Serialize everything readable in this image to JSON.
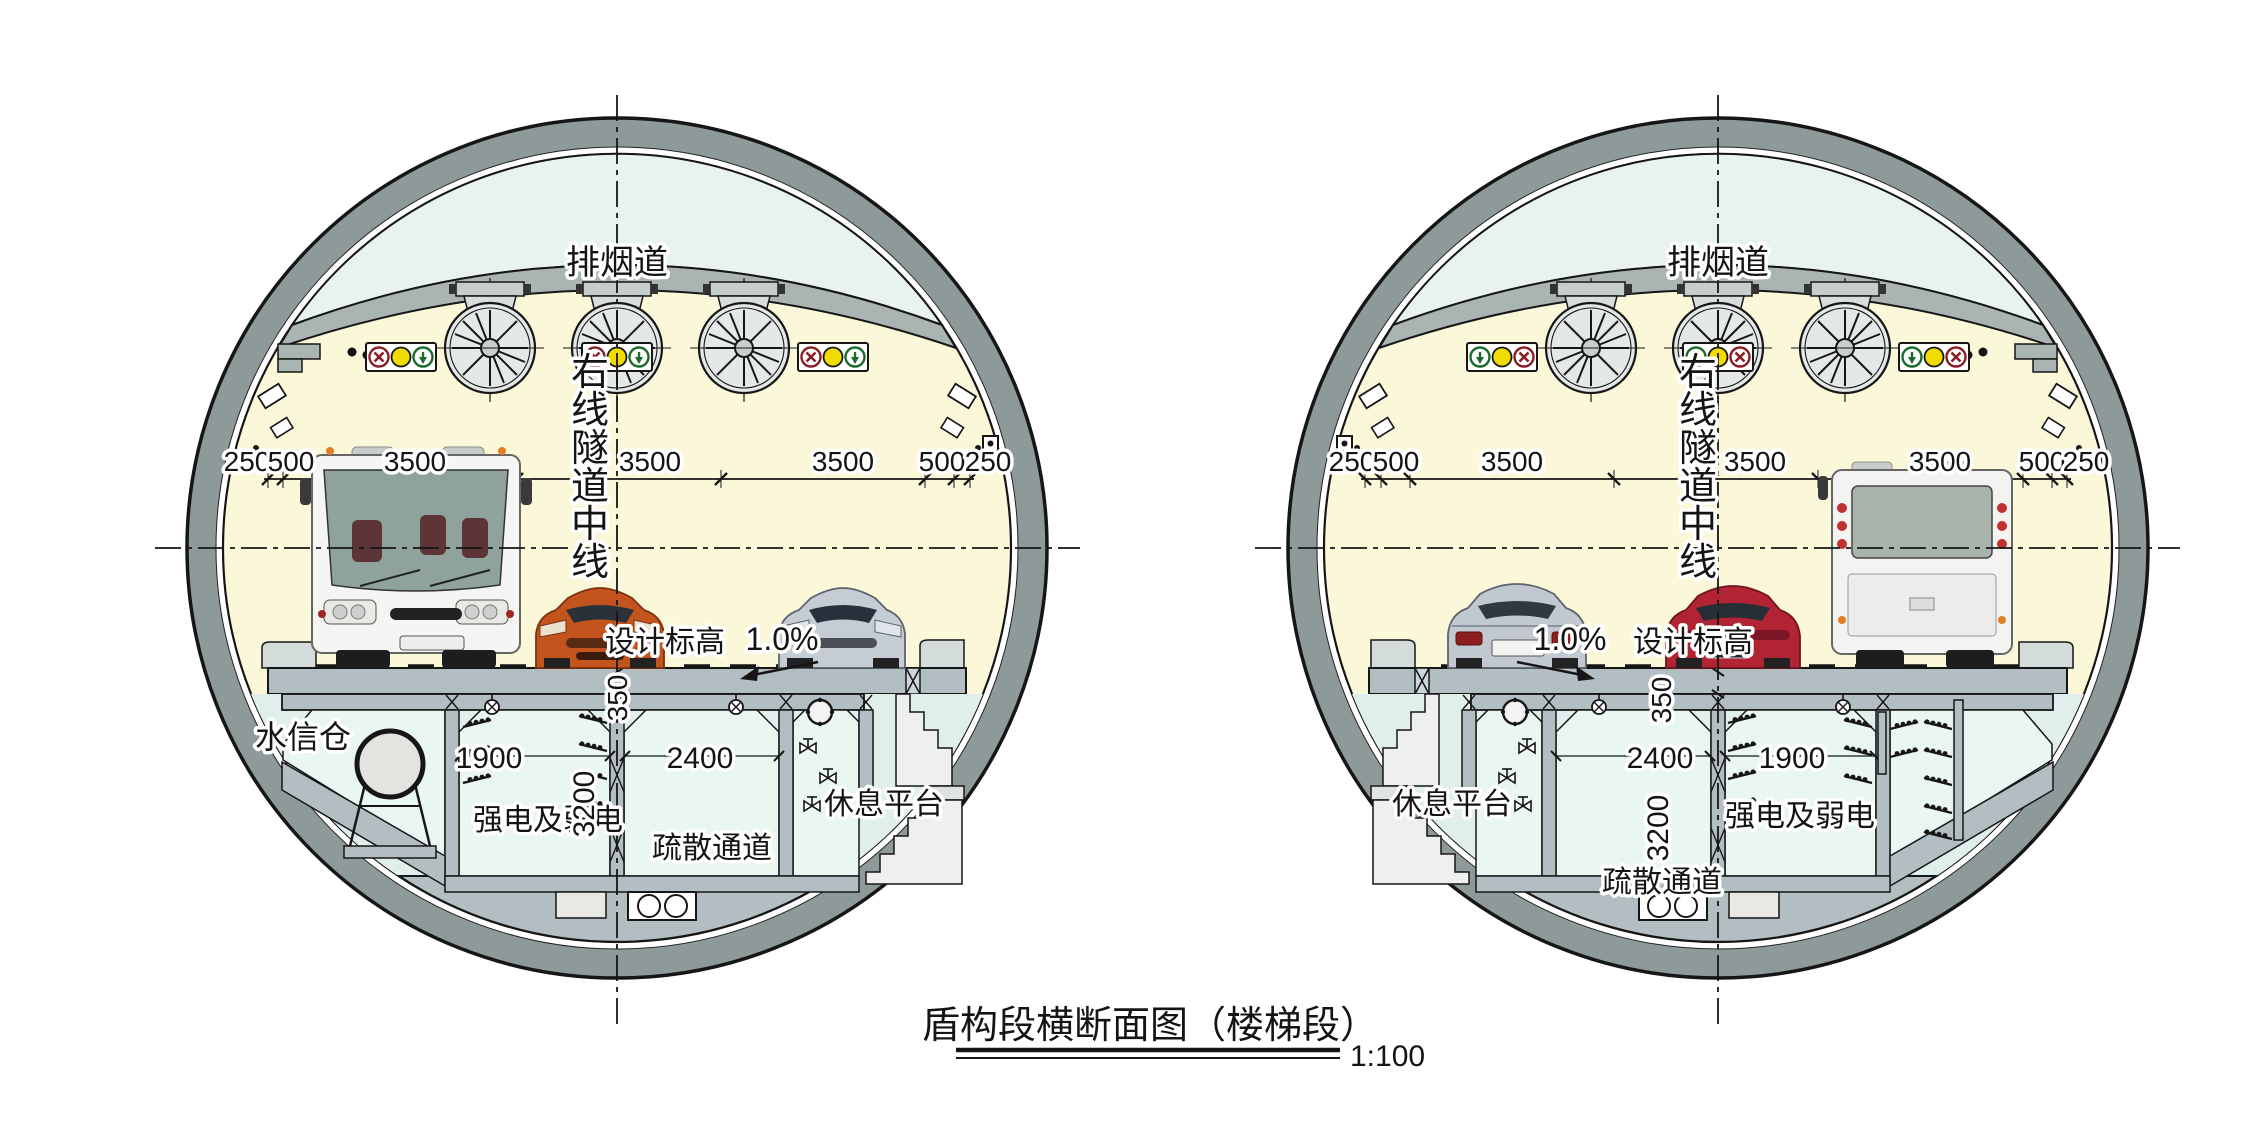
{
  "title": {
    "text": "盾构段横断面图（楼梯段）",
    "scale": "1:100"
  },
  "tunnel_left": {
    "smoke_duct": "排烟道",
    "centerline_label": "右线隧道中线",
    "design_elevation": "设计标高",
    "slope": "1.0%",
    "deck_thickness": "350",
    "dims": [
      "250",
      "500",
      "3500",
      "3500",
      "3500",
      "500",
      "250"
    ],
    "water_bay": "水信仓",
    "power_bay_width": "1900",
    "evac_width": "2400",
    "evac_height": "3200",
    "power_bay": "强电及弱电",
    "evac_channel": "疏散通道",
    "rest_platform": "休息平台"
  },
  "tunnel_right": {
    "smoke_duct": "排烟道",
    "centerline_label": "右线隧道中线",
    "design_elevation": "设计标高",
    "slope": "1.0%",
    "deck_thickness": "350",
    "dims": [
      "250",
      "500",
      "3500",
      "3500",
      "3500",
      "500",
      "250"
    ],
    "power_bay_width": "1900",
    "evac_width": "2400",
    "evac_height": "3200",
    "power_bay": "强电及弱电",
    "evac_channel": "疏散通道",
    "rest_platform": "休息平台"
  },
  "colors": {
    "lining": "#8e9a99",
    "cavity": "#fbf7d9",
    "smoke_duct": "#e9f3ee",
    "slab": "#a9b4b3",
    "road": "#b3bec2",
    "room": "#e9f6f2",
    "signal_red": "#8a2026",
    "signal_yellow": "#f2dc00",
    "signal_green": "#1c6b2d"
  }
}
